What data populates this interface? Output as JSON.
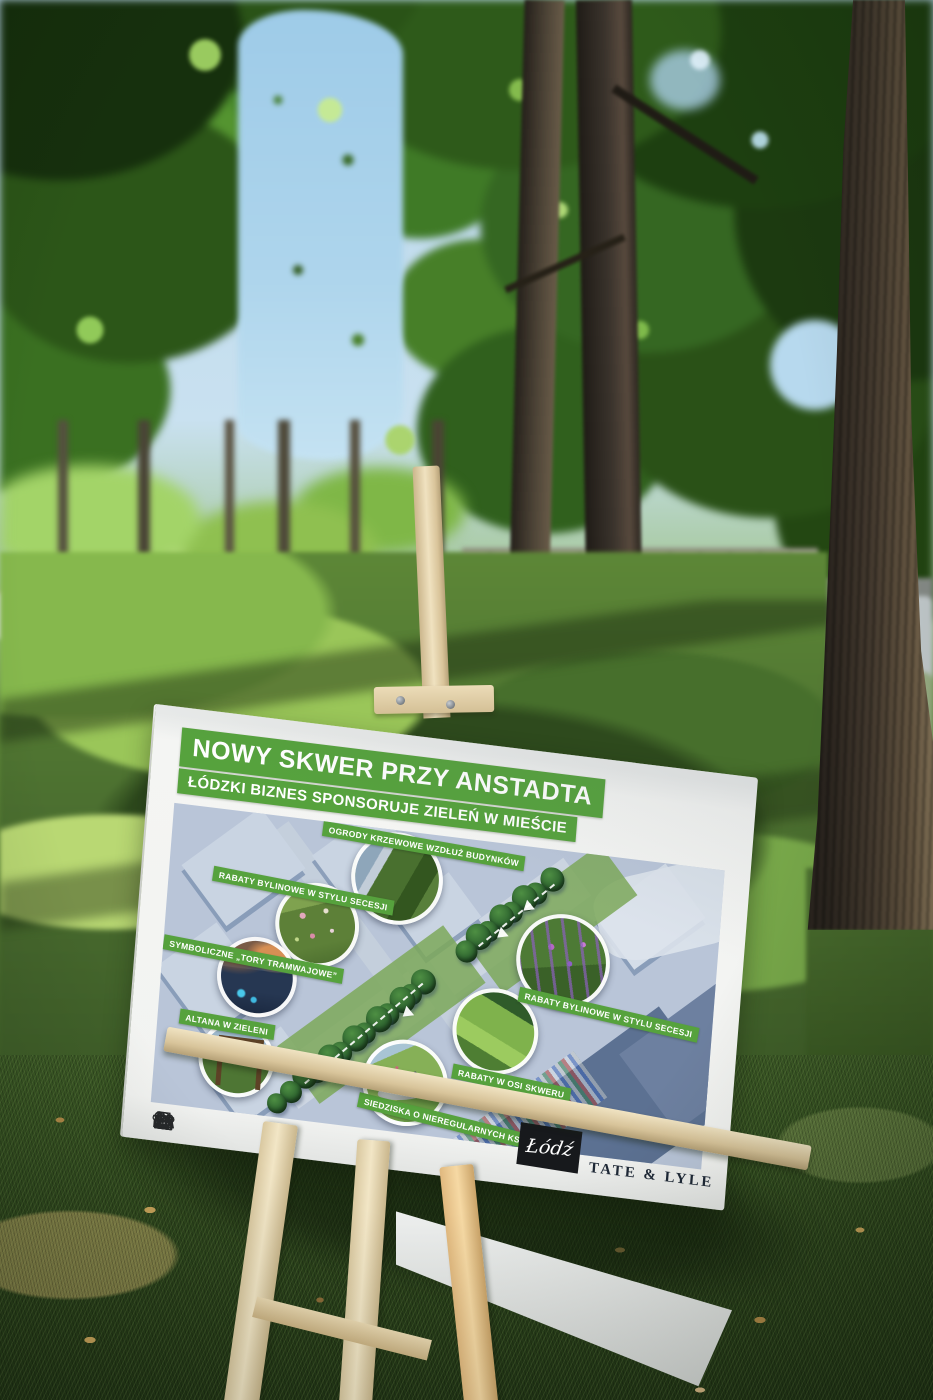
{
  "scene": {
    "license_plate_fragment": "561"
  },
  "poster": {
    "title": "NOWY SKWER PRZY ANSTADTA",
    "subtitle": "ŁÓDZKI BIZNES SPONSORUJE ZIELEŃ W MIEŚCIE",
    "callouts": [
      {
        "label": "OGRODY KRZEWOWE WZDŁUŻ BUDYNKÓW"
      },
      {
        "label": "RABATY BYLINOWE W STYLU SECESJI"
      },
      {
        "label": "SYMBOLICZNE „TORY TRAMWAJOWE”"
      },
      {
        "label": "ALTANA W ZIELENI"
      },
      {
        "label": "RABATY BYLINOWE W STYLU SECESJI"
      },
      {
        "label": "RABATY W OSI SKWERU"
      },
      {
        "label": "SIEDZISKA O NIEREGULARNYCH KSZTAŁTACH"
      }
    ],
    "legend_icons": [
      "two-trees",
      "tenement-building",
      "bench-with-tree",
      "quartered-circle-plan",
      "viaduct-arches",
      "conifer-trees",
      "palace-facade",
      "tree-and-bench",
      "arched-gate",
      "gazebo-with-trees"
    ],
    "logos": {
      "city": "Łódź",
      "sponsor": "TATE & LYLE"
    }
  },
  "colors": {
    "banner_green": "#56a23d",
    "poster_paper": "#f3f4f2",
    "map_tone": "#b9c5d8",
    "easel_wood": "#e6d5ae",
    "lodz_box": "#17191c",
    "sponsor_navy": "#1e2836",
    "sky": "#b9d7ea",
    "foliage_dark": "#274f16",
    "grass_shade": "#2c441c"
  }
}
